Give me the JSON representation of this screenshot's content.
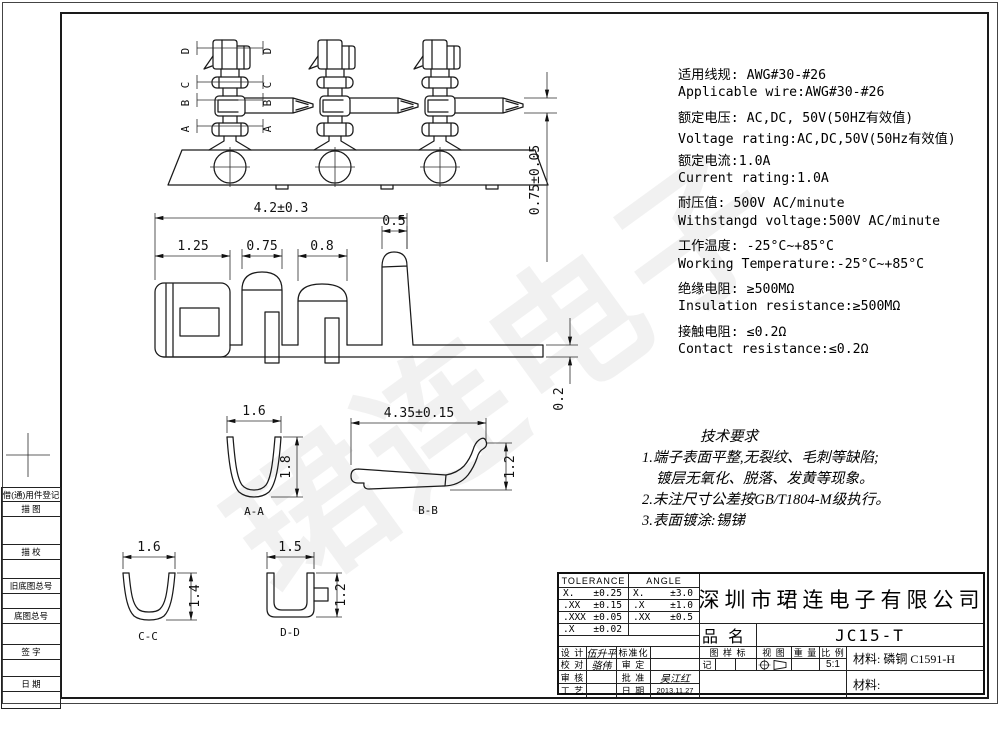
{
  "watermark": {
    "text": "珺连电子"
  },
  "specs": {
    "lines": [
      "适用线规: AWG#30-#26",
      "Applicable wire:AWG#30-#26",
      "额定电压: AC,DC, 50V(50HZ有效值)",
      "Voltage rating:AC,DC,50V(50Hz有效值)",
      "额定电流:1.0A",
      "Current rating:1.0A",
      "耐压值: 500V AC/minute",
      "Withstangd voltage:500V AC/minute",
      "工作温度: -25°C~+85°C",
      "Working Temperature:-25°C~+85°C",
      "绝缘电阻: ≥500MΩ",
      "Insulation resistance:≥500MΩ",
      "接触电阻: ≤0.2Ω",
      "Contact resistance:≤0.2Ω"
    ]
  },
  "tech": {
    "title": "技术要求",
    "lines": [
      "1.端子表面平整,无裂纹、毛刺等缺陷;",
      "镀层无氧化、脱落、发黄等现象。",
      "2.未注尺寸公差按GB/T1804-M级执行。",
      "3.表面镀涂:锡锑"
    ]
  },
  "dims": {
    "tip": "0.75±0.05",
    "overall": "4.2±0.3",
    "seg1": "1.25",
    "seg2": "0.75",
    "seg3": "0.8",
    "pin": "0.5",
    "thickness": "0.2",
    "aa_w": "1.6",
    "aa_h": "1.8",
    "bb_w": "4.35±0.15",
    "bb_h": "1.2",
    "cc_w": "1.6",
    "cc_h": "1.4",
    "dd_w": "1.5",
    "dd_h": "1.2"
  },
  "sections": {
    "aa": "A-A",
    "bb": "B-B",
    "cc": "C-C",
    "dd": "D-D",
    "cuts": [
      "D",
      "C",
      "B",
      "A"
    ]
  },
  "title_block": {
    "tolerance": {
      "header": "TOLERANCE",
      "rows": [
        {
          "k": "X.",
          "v": "±0.25"
        },
        {
          "k": ".XX",
          "v": "±0.15"
        },
        {
          "k": ".XXX",
          "v": "±0.05"
        },
        {
          "k": ".X",
          "v": "±0.02"
        }
      ]
    },
    "angle": {
      "header": "ANGLE",
      "rows": [
        {
          "k": "X.",
          "v": "±3.0"
        },
        {
          "k": ".X",
          "v": "±1.0"
        },
        {
          "k": ".XX",
          "v": "±0.5"
        }
      ]
    },
    "company": "深圳市珺连电子有限公司",
    "product_label": "品名",
    "product_value": "JC15-T",
    "sign_rows": [
      {
        "l1": "设 计",
        "v1": "伍升平",
        "l2": "标准化",
        "v2": ""
      },
      {
        "l1": "校 对",
        "v1": "骆伟",
        "l2": "审 定",
        "v2": ""
      },
      {
        "l1": "审 核",
        "v1": "",
        "l2": "批 准",
        "v2": "吴江红"
      },
      {
        "l1": "工 艺",
        "v1": "",
        "l2": "日 期",
        "v2": "2013.11.27"
      }
    ],
    "mark": {
      "l1": "图 样 标",
      "l2": "记"
    },
    "view_label": "视 图",
    "weight_label": "重 量",
    "scale_label": "比 例",
    "scale_value": "5:1",
    "material_top": {
      "label": "材料:",
      "value": "磷铜 C1591-H"
    },
    "material_bottom": {
      "label": "材料:",
      "value": ""
    }
  },
  "left_margin": {
    "cells": [
      "借(通)用件登记",
      "描  图",
      "描  校",
      "旧底图总号",
      "底图总号",
      "签  字",
      "日  期"
    ]
  }
}
